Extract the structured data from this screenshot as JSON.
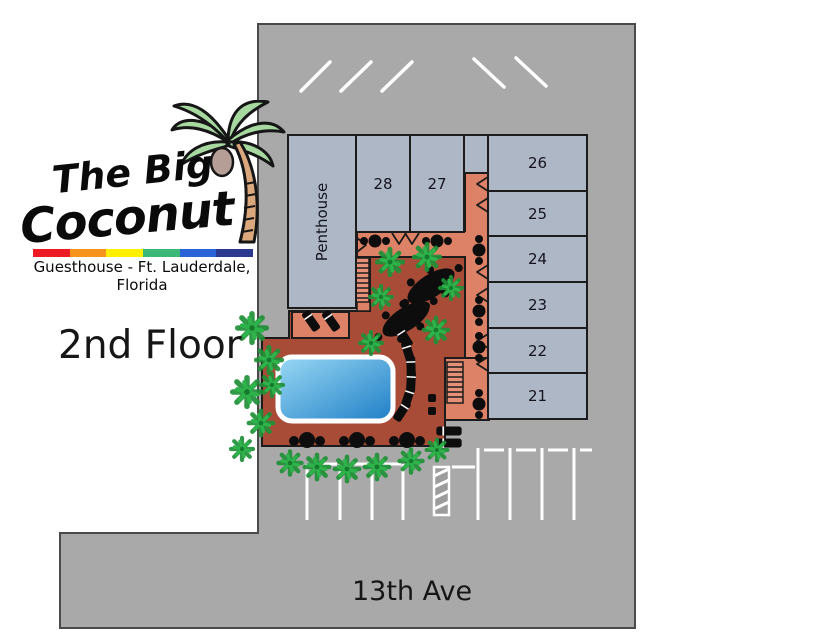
{
  "logo": {
    "title_line1": "The Big",
    "title_line2": "Coconut",
    "subtitle": "Guesthouse - Ft. Lauderdale, Florida",
    "rainbow_colors": [
      "#ed1c24",
      "#f7941d",
      "#ffef00",
      "#3cb878",
      "#2a62d8",
      "#2b3990"
    ]
  },
  "labels": {
    "floor": "2nd Floor",
    "street": "13th Ave"
  },
  "map": {
    "rooms": [
      {
        "id": "penthouse",
        "label": "Penthouse"
      },
      {
        "id": "28",
        "label": "28"
      },
      {
        "id": "27",
        "label": "27"
      },
      {
        "id": "26",
        "label": "26"
      },
      {
        "id": "25",
        "label": "25"
      },
      {
        "id": "24",
        "label": "24"
      },
      {
        "id": "23",
        "label": "23"
      },
      {
        "id": "22",
        "label": "22"
      },
      {
        "id": "21",
        "label": "21"
      }
    ],
    "colors": {
      "property": "#a9a9a9",
      "room_fill": "#aeb7c6",
      "walkway": "#dd8266",
      "courtyard": "#a84c38",
      "pool_light": "#9ad9f5",
      "pool_dark": "#1e7ec6",
      "palm_green": "#2eb24a",
      "outline": "#1c1c1c"
    }
  }
}
